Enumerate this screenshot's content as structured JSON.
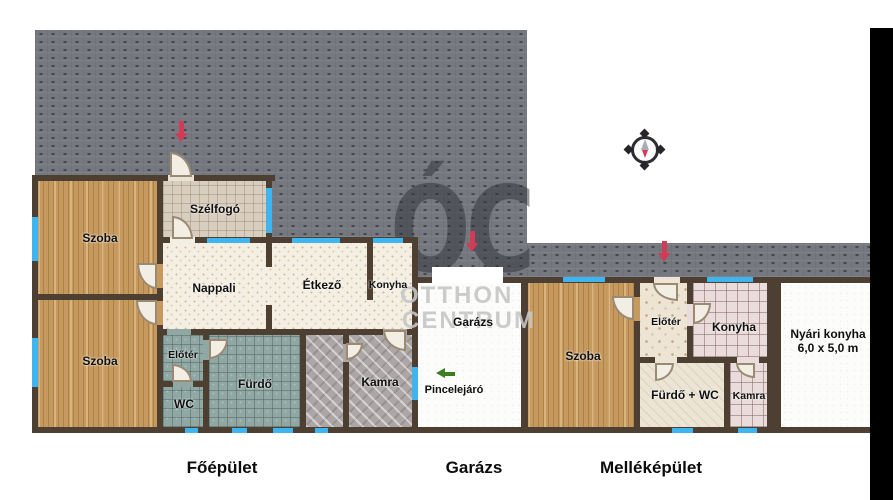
{
  "plan": {
    "bottom_labels": {
      "main": "Főépület",
      "garage": "Garázs",
      "outbuilding": "Melléképület"
    },
    "main_building": {
      "szoba_top": "Szoba",
      "szoba_bottom": "Szoba",
      "szelfogo": "Szélfogó",
      "nappali": "Nappali",
      "etkezo": "Étkező",
      "konyha": "Konyha",
      "eloter": "Előtér",
      "wc": "WC",
      "furdo": "Fürdő",
      "kamra": "Kamra"
    },
    "garage": {
      "room": "Garázs",
      "cellar": "Pincelejáró"
    },
    "outbuilding": {
      "szoba": "Szoba",
      "eloter": "Előtér",
      "konyha": "Konyha",
      "furdo_wc": "Fürdő + WC",
      "kamra": "Kamra",
      "nyari_konyha": "Nyári konyha",
      "nyari_konyha_size": "6,0 x 5,0 m"
    },
    "watermark": {
      "monogram": "ÓC",
      "line1": "OTTHON",
      "line2": "CENTRUM"
    },
    "icons": {
      "compass": "compass-rose-icon",
      "entrance_arrows": "entrance-arrow-icon",
      "cellar_arrow": "cellar-direction-arrow-icon"
    },
    "colors": {
      "paving": "#75787f",
      "wall": "#4d3f31",
      "window": "#3eb5ef",
      "entrance_arrow": "#d23b55",
      "cellar_arrow": "#3c7c23"
    }
  }
}
